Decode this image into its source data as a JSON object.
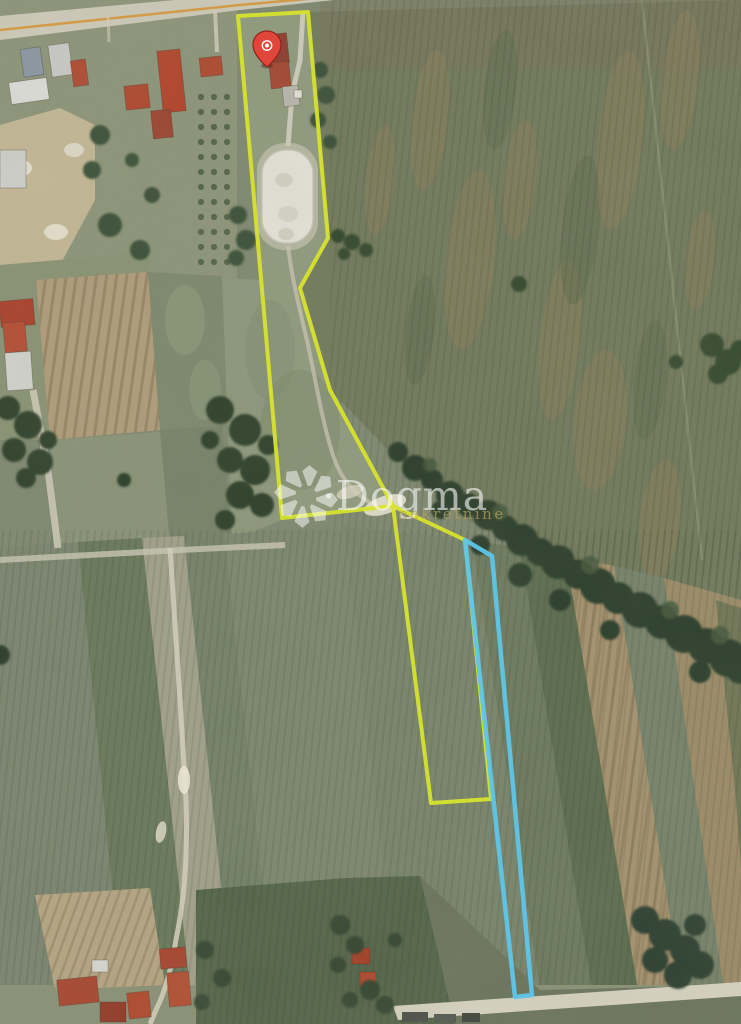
{
  "image": {
    "kind": "aerial-satellite-photo",
    "width_px": 741,
    "height_px": 1024
  },
  "watermark": {
    "brand": "Dogma",
    "brand_display": "·Dogma",
    "subtitle": "nekretnine",
    "logo": "pinwheel-petals-icon",
    "brand_color": "#ffffff",
    "subtitle_color": "#b9a45f"
  },
  "map_marker": {
    "name": "location-pin",
    "color": "#e0463a",
    "ring_color": "#ffffff"
  },
  "overlays": {
    "boundary_yellow": {
      "label": "main-parcel-outline",
      "color": "#d7e32f"
    },
    "boundary_blue": {
      "label": "adjacent-parcel-outline",
      "color": "#5fc6e9"
    }
  },
  "palette": {
    "field_green_grey": "#7d8770",
    "field_dark_green": "#5d6c4f",
    "field_tan": "#a5926f",
    "plowed_tan": "#b09c7b",
    "trees_dark": "#33452f",
    "track_light": "#d8d2c1",
    "roof_red": "#b0462e",
    "road_edge_orange": "#d89a42",
    "arena_white": "#e6e4da"
  }
}
